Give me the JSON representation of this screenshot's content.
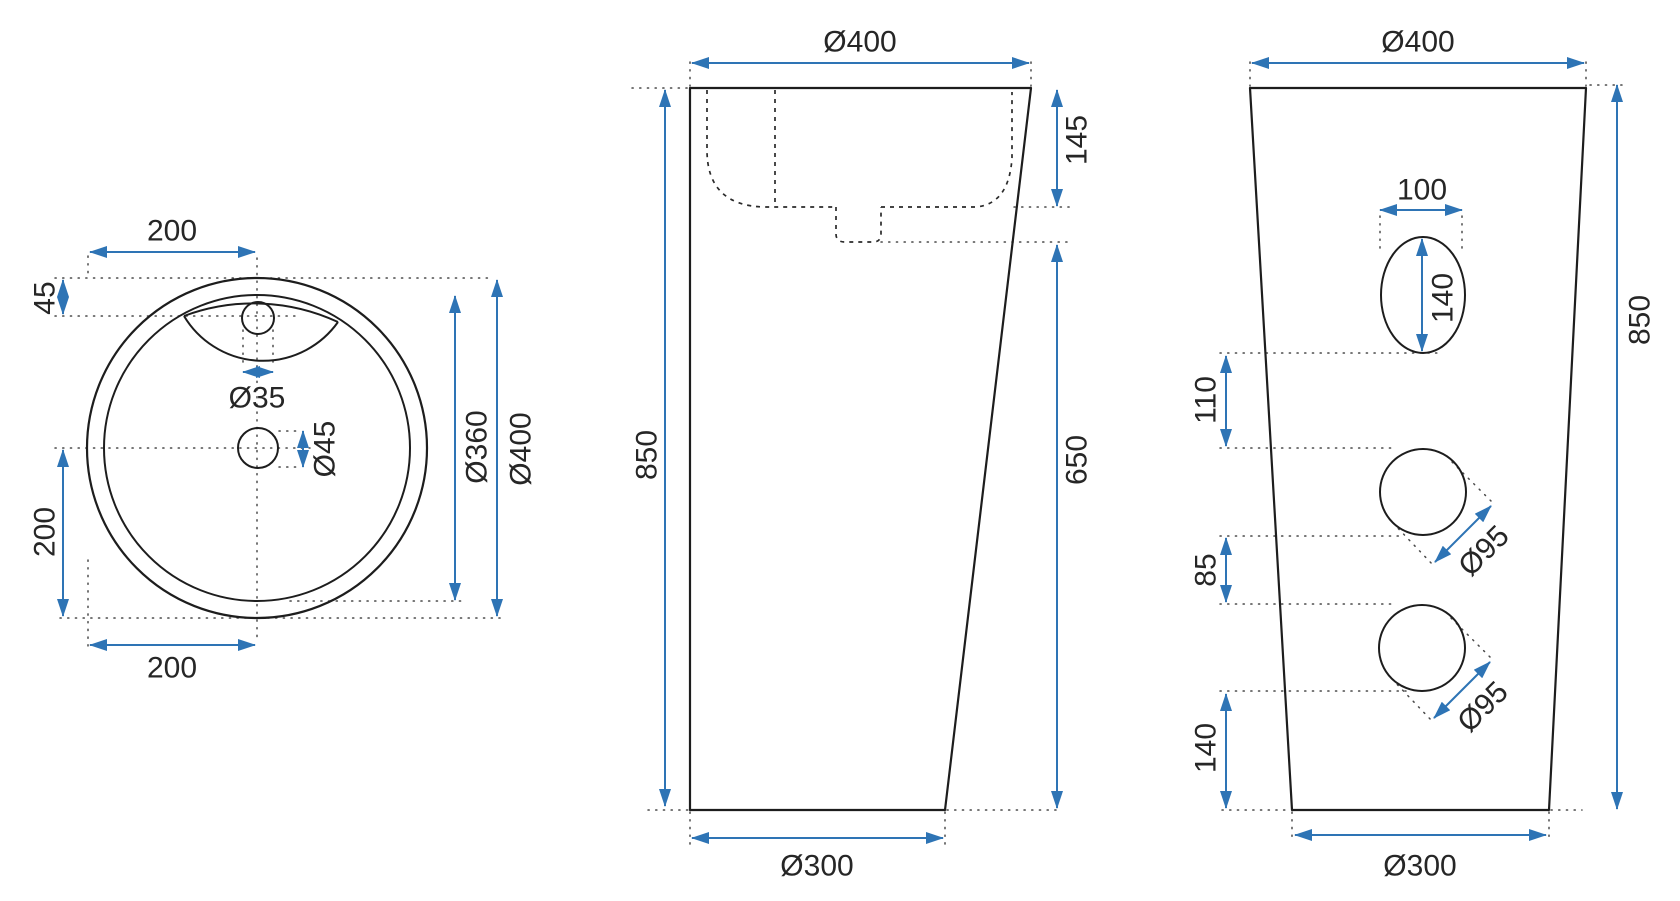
{
  "document": {
    "type": "technical-drawing",
    "subject": "freestanding pedestal washbasin, three orthographic views",
    "units": "mm"
  },
  "colors": {
    "dimension_accent": "#2e74b5",
    "outline": "#1d1d1d",
    "background": "#ffffff"
  },
  "views": {
    "top": {
      "label": "top view",
      "dims": {
        "top_width": "200",
        "faucet_offset": "45",
        "faucet_hole": "Ø35",
        "drain_hole": "Ø45",
        "center_to_edge": "200",
        "bottom_width": "200",
        "inner_diameter": "Ø360",
        "outer_diameter": "Ø400"
      }
    },
    "front": {
      "label": "front view",
      "dims": {
        "top_diameter": "Ø400",
        "bowl_depth": "145",
        "total_height": "850",
        "lower_height": "650",
        "base_diameter": "Ø300"
      }
    },
    "side": {
      "label": "side view",
      "dims": {
        "top_diameter": "Ø400",
        "oval_hole_width": "100",
        "oval_hole_height": "140",
        "oval_to_hole1": "110",
        "hole1_diameter": "Ø95",
        "hole1_to_hole2": "85",
        "hole2_diameter": "Ø95",
        "hole2_to_base": "140",
        "total_height": "850",
        "base_diameter": "Ø300"
      }
    }
  }
}
